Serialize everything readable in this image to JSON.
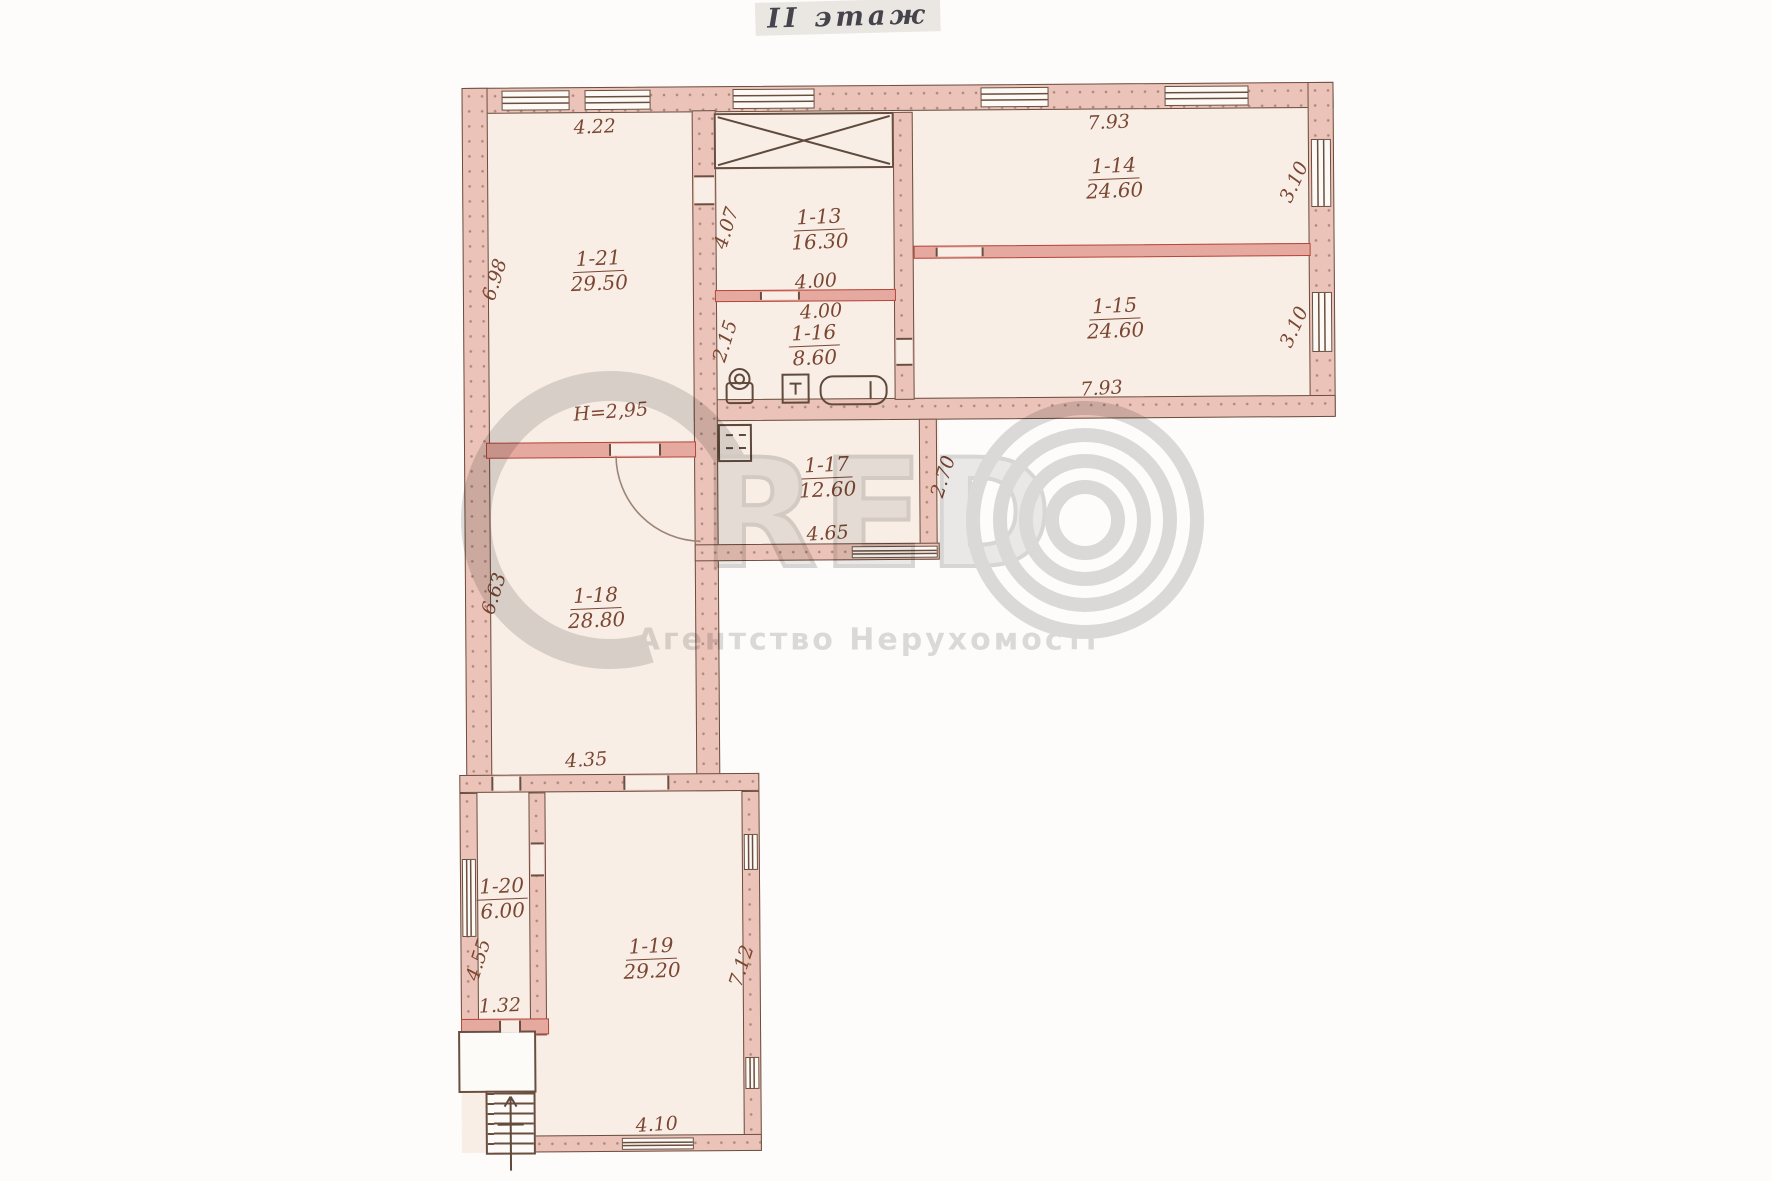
{
  "title": "II этаж",
  "note": {
    "ceiling_height": "H=2,95"
  },
  "rooms": {
    "r21": {
      "number": "1-21",
      "area": "29.50"
    },
    "r13": {
      "number": "1-13",
      "area": "16.30"
    },
    "r14": {
      "number": "1-14",
      "area": "24.60"
    },
    "r15": {
      "number": "1-15",
      "area": "24.60"
    },
    "r16": {
      "number": "1-16",
      "area": "8.60"
    },
    "r17": {
      "number": "1-17",
      "area": "12.60"
    },
    "r18": {
      "number": "1-18",
      "area": "28.80"
    },
    "r19": {
      "number": "1-19",
      "area": "29.20"
    },
    "r20": {
      "number": "1-20",
      "area": "6.00"
    }
  },
  "dimensions": {
    "top_1_21": "4.22",
    "left_1_21": "6.98",
    "top_1_14": "7.93",
    "right_1_14": "3.10",
    "right_1_15": "3.10",
    "left_1_13": "4.07",
    "width_1_13": "4.00",
    "width_1_16": "4.00",
    "left_1_16": "2.15",
    "bottom_1_15": "7.93",
    "right_1_17": "2.70",
    "bottom_1_17": "4.65",
    "left_1_18": "6.63",
    "bottom_1_18": "4.35",
    "left_1_20": "4.55",
    "bottom_1_20": "1.32",
    "right_1_19": "7.12",
    "bottom_1_19": "4.10"
  },
  "watermark": {
    "brand": "RED",
    "subtitle": "Агентство Нерухомості"
  },
  "icons": {
    "stair_shaft": "crossed-box",
    "toilet": "toilet-top-view",
    "sink": "sink-top-view",
    "bathtub": "bathtub-top-view",
    "door_swing": "quarter-arc",
    "stairs_arrow": "direction-arrow"
  },
  "colors": {
    "wall_fill": "#ecc3b8",
    "wall_line": "#6a4e3f",
    "red_partition": "#b5473c",
    "ink": "#7b4632",
    "paper_tint": "#f8eee6",
    "watermark_gray": "#d8d8d8"
  }
}
